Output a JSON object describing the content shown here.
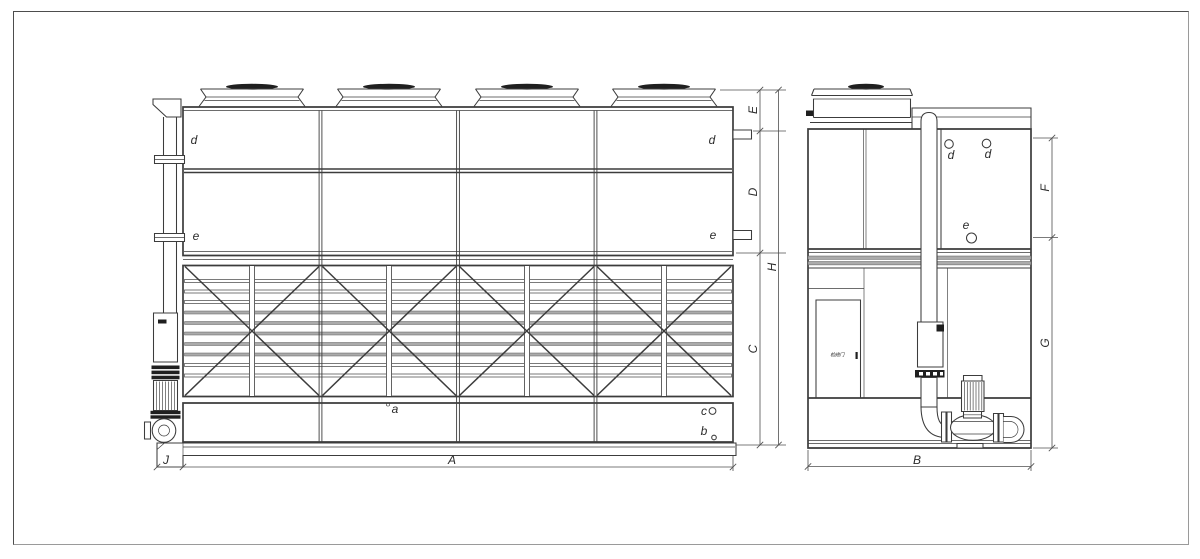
{
  "drawing": {
    "dims": {
      "A": "A",
      "B": "B",
      "C": "C",
      "D": "D",
      "E": "E",
      "F": "F",
      "G": "G",
      "H": "H",
      "J": "J"
    },
    "parts": {
      "a": "a",
      "b": "b",
      "c": "c",
      "d": "d",
      "e": "e"
    },
    "door_label": "检修门",
    "colors": {
      "line": "#3c3c3c",
      "dimension_line": "#4f4f4f",
      "louver_fill": "#ababab",
      "dark_fill": "#1f1f1f",
      "background": "#ffffff",
      "sheet_border": "#777777"
    }
  }
}
